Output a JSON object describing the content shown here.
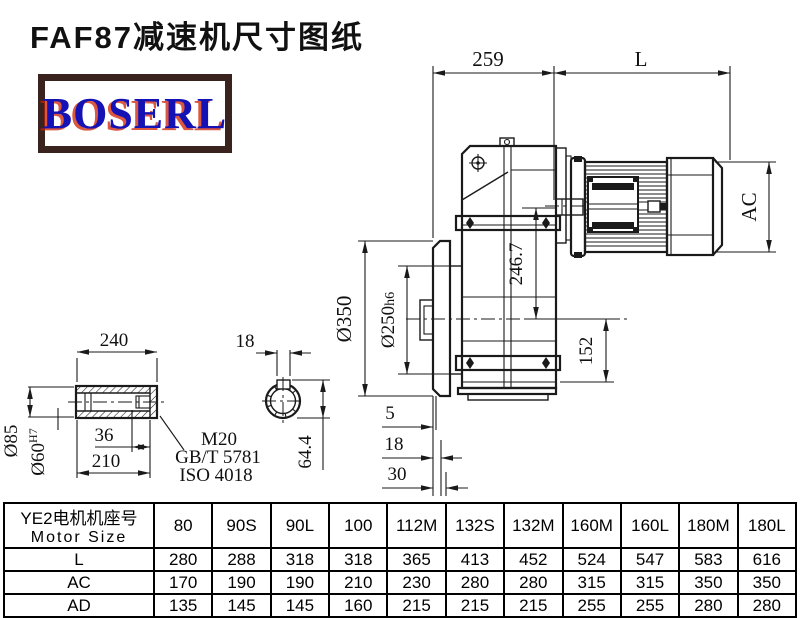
{
  "header": {
    "title": "FAF87减速机尺寸图纸",
    "logo_text": "BOSERL"
  },
  "drawing": {
    "dims": {
      "reducer_length": "259",
      "motor_length": "L",
      "motor_diameter": "AC",
      "axis_distance": "246.7",
      "center_to_base": "152",
      "flange_od": "Ø350",
      "spigot_dia": "Ø250",
      "spigot_fit": "h6",
      "offset_a": "5",
      "offset_b": "18",
      "offset_c": "30"
    },
    "shaft": {
      "total_length": "240",
      "outer_dia": "Ø85",
      "bore_dia": "Ø60",
      "bore_fit": "H7",
      "key_engage": "36",
      "hub_length": "210",
      "thread": "M20",
      "standard_gb": "GB/T 5781",
      "standard_iso": "ISO 4018",
      "key_width": "18",
      "key_height": "64.4"
    }
  },
  "table": {
    "row_header_cn": "YE2电机机座号",
    "row_header_en": "Motor Size",
    "columns": [
      "80",
      "90S",
      "90L",
      "100",
      "112M",
      "132S",
      "132M",
      "160M",
      "160L",
      "180M",
      "180L"
    ],
    "rows": [
      {
        "label": "L",
        "values": [
          "280",
          "288",
          "318",
          "318",
          "365",
          "413",
          "452",
          "524",
          "547",
          "583",
          "616"
        ]
      },
      {
        "label": "AC",
        "values": [
          "170",
          "190",
          "190",
          "210",
          "230",
          "280",
          "280",
          "315",
          "315",
          "350",
          "350"
        ]
      },
      {
        "label": "AD",
        "values": [
          "135",
          "145",
          "145",
          "160",
          "215",
          "215",
          "215",
          "255",
          "255",
          "280",
          "280"
        ]
      }
    ]
  }
}
